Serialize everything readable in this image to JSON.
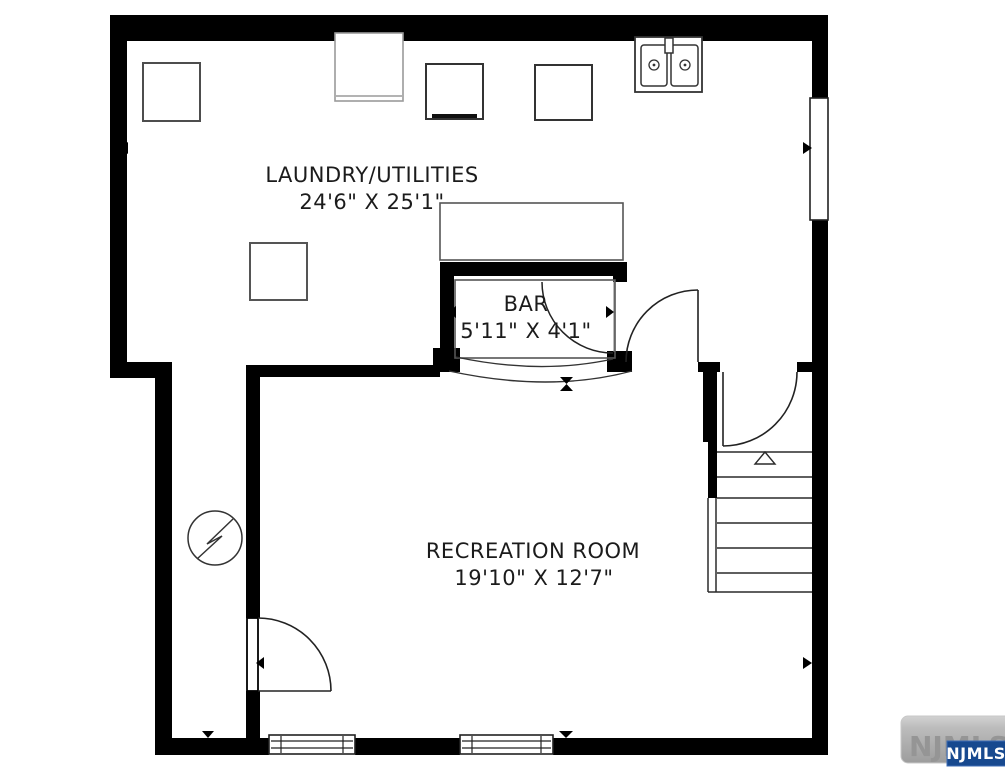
{
  "floorplan": {
    "rooms": [
      {
        "name": "LAUNDRY/UTILITIES",
        "dimensions": "24'6\" X 25'1\""
      },
      {
        "name": "BAR",
        "dimensions": "5'11\" X 4'1\""
      },
      {
        "name": "RECREATION ROOM",
        "dimensions": "19'10\" X 12'7\""
      }
    ],
    "icons": [
      "appliance-square-icon",
      "washer-icon",
      "dryer-icon",
      "double-sink-icon",
      "storage-square-icon",
      "counter-icon",
      "bar-counter-icon",
      "electrical-panel-icon",
      "stairs-icon",
      "door-swing-icon",
      "window-icon",
      "dimension-arrow-icon"
    ],
    "colors": {
      "wall": "#000000",
      "background": "#ffffff",
      "text": "#1b1b1b",
      "fixture_outline": "#4d4d4d",
      "watermark_gray_box": "#b3b3b3",
      "watermark_blue_box": "#17498f"
    },
    "watermark": {
      "background_text": "NJMLS",
      "badge_text": "NJMLS"
    }
  }
}
